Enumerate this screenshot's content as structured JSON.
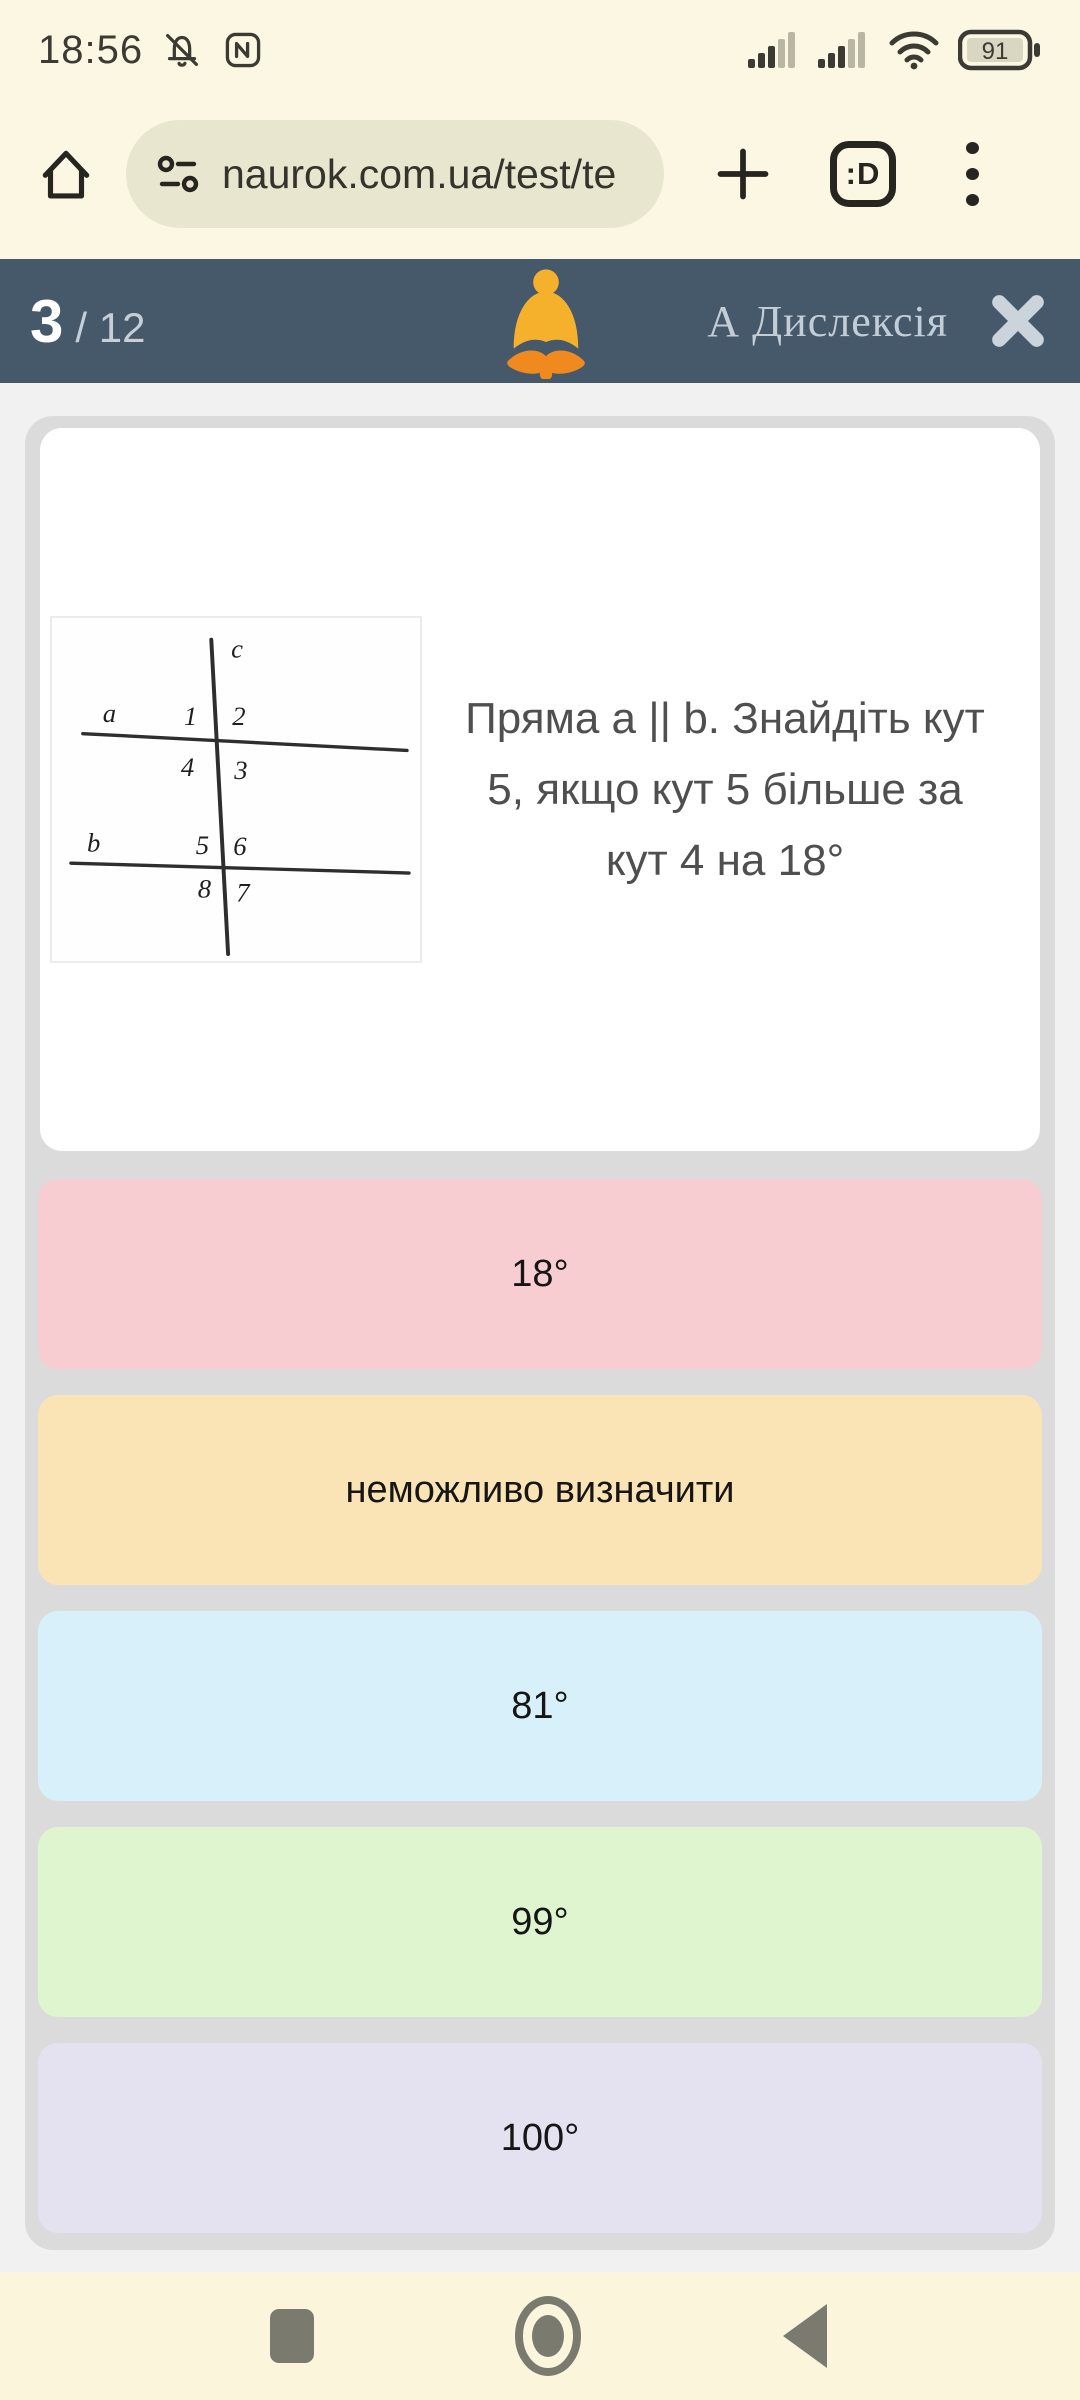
{
  "status_bar": {
    "time": "18:56",
    "battery_percent": "91",
    "icons": {
      "notifications_muted": "bell-slash",
      "nfc": "nfc",
      "signal_sim1": "cellular 3 of 5 bars",
      "signal_sim2": "cellular 3 of 5 bars",
      "wifi": "wifi full"
    }
  },
  "browser_bar": {
    "url": "naurok.com.ua/test/te",
    "tab_count_label": ":D"
  },
  "quiz_header": {
    "current_question": "3",
    "total_label": "/ 12",
    "dyslexia_label": "А Дислексія",
    "bg_color": "#46596B",
    "bell_yellow": "#F6B12C",
    "bell_orange": "#F08A1F"
  },
  "question": {
    "text": "Пряма a || b. Знайдіть кут 5, якщо кут 5 більше за кут 4 на 18°",
    "figure": {
      "labels": {
        "a": "a",
        "b": "b",
        "c": "c",
        "n1": "1",
        "n2": "2",
        "n3": "3",
        "n4": "4",
        "n5": "5",
        "n6": "6",
        "n7": "7",
        "n8": "8"
      }
    }
  },
  "options": [
    {
      "label": "18°",
      "color": "#F7CDD2"
    },
    {
      "label": "неможливо визначити",
      "color": "#FAE3B4"
    },
    {
      "label": "81°",
      "color": "#D8F0F9"
    },
    {
      "label": "99°",
      "color": "#DFF5D0"
    },
    {
      "label": "100°",
      "color": "#E4E2F1"
    }
  ]
}
